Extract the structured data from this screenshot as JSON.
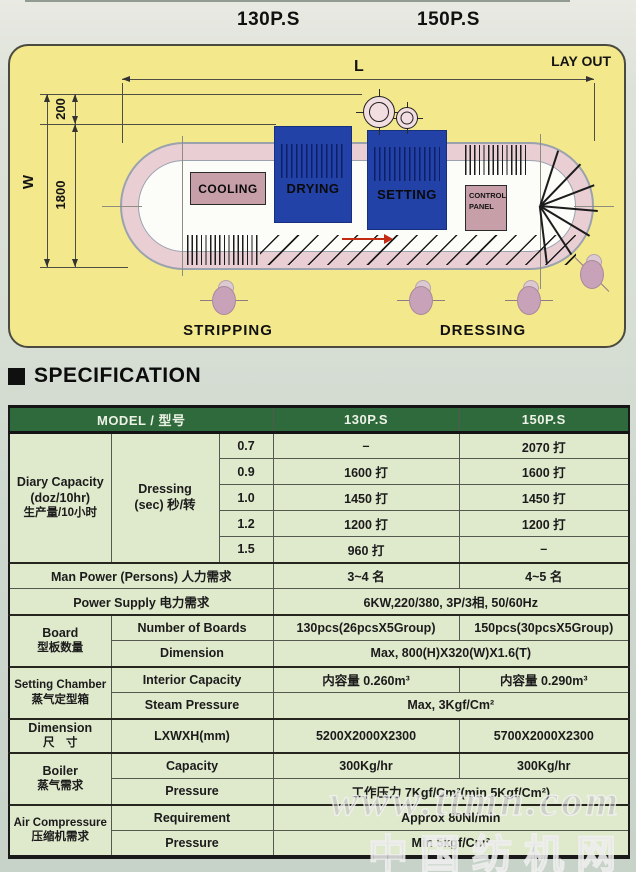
{
  "page": {
    "models": [
      "130P.S",
      "150P.S"
    ]
  },
  "layout": {
    "label": "LAY OUT",
    "dim_l": "L",
    "dim_w": "W",
    "dim_200": "200",
    "dim_1800": "1800",
    "stations": {
      "cooling": "COOLING",
      "drying": "DRYING",
      "setting": "SETTING",
      "control_panel": "CONTROL PANEL"
    },
    "positions": {
      "stripping": "STRIPPING",
      "dressing": "DRESSING"
    }
  },
  "spec": {
    "heading": "SPECIFICATION",
    "columns": {
      "model": "MODEL / 型号",
      "m130": "130P.S",
      "m150": "150P.S"
    },
    "diary_capacity": {
      "label1": "Diary Capacity",
      "label2": "(doz/10hr)",
      "label3": "生产量/10小时",
      "dressing1": "Dressing",
      "dressing2": "(sec) 秒/转",
      "rows": [
        {
          "speed": "0.7",
          "v130": "–",
          "v150": "2070 打"
        },
        {
          "speed": "0.9",
          "v130": "1600 打",
          "v150": "1600 打"
        },
        {
          "speed": "1.0",
          "v130": "1450 打",
          "v150": "1450 打"
        },
        {
          "speed": "1.2",
          "v130": "1200 打",
          "v150": "1200 打"
        },
        {
          "speed": "1.5",
          "v130": "960 打",
          "v150": "–"
        }
      ]
    },
    "man_power": {
      "label": "Man Power (Persons)  人力需求",
      "v130": "3~4 名",
      "v150": "4~5 名"
    },
    "power_supply": {
      "label": "Power Supply  电力需求",
      "value": "6KW,220/380, 3P/3相, 50/60Hz"
    },
    "board": {
      "label1": "Board",
      "label2": "型板数量",
      "number": {
        "label": "Number of Boards",
        "v130": "130pcs(26pcsX5Group)",
        "v150": "150pcs(30pcsX5Group)"
      },
      "dimension": {
        "label": "Dimension",
        "value": "Max, 800(H)X320(W)X1.6(T)"
      }
    },
    "setting_chamber": {
      "label1": "Setting Chamber",
      "label2": "蒸气定型箱",
      "interior": {
        "label": "Interior Capacity",
        "v130": "内容量 0.260m³",
        "v150": "内容量 0.290m³"
      },
      "steam": {
        "label": "Steam Pressure",
        "value": "Max, 3Kgf/Cm²"
      }
    },
    "dimension": {
      "label1": "Dimension",
      "label2": "尺　寸",
      "lxwxh": {
        "label": "LXWXH(mm)",
        "v130": "5200X2000X2300",
        "v150": "5700X2000X2300"
      }
    },
    "boiler": {
      "label1": "Boiler",
      "label2": "蒸气需求",
      "capacity": {
        "label": "Capacity",
        "v130": "300Kg/hr",
        "v150": "300Kg/hr"
      },
      "pressure": {
        "label": "Pressure",
        "value": "工作压力 7Kgf/Cm²(min 5Kgf/Cm²)"
      }
    },
    "air_compressure": {
      "label1": "Air Compressure",
      "label2": "压缩机需求",
      "requirement": {
        "label": "Requirement",
        "value": "Approx 80Nl/min"
      },
      "pressure": {
        "label": "Pressure",
        "value": "Min 5kgf/Cm²"
      }
    }
  },
  "watermark": {
    "line1": "www.ttmn.com",
    "line2": "中国纺机网"
  },
  "colors": {
    "panel_yellow": "#f4e88d",
    "header_green": "#2f6a3c",
    "table_body": "#dfe9cc",
    "machine_blue": "#2342a8",
    "track_pink": "#e9ced4",
    "station_mauve": "#c79fa8",
    "arrow_red": "#c32a12"
  }
}
